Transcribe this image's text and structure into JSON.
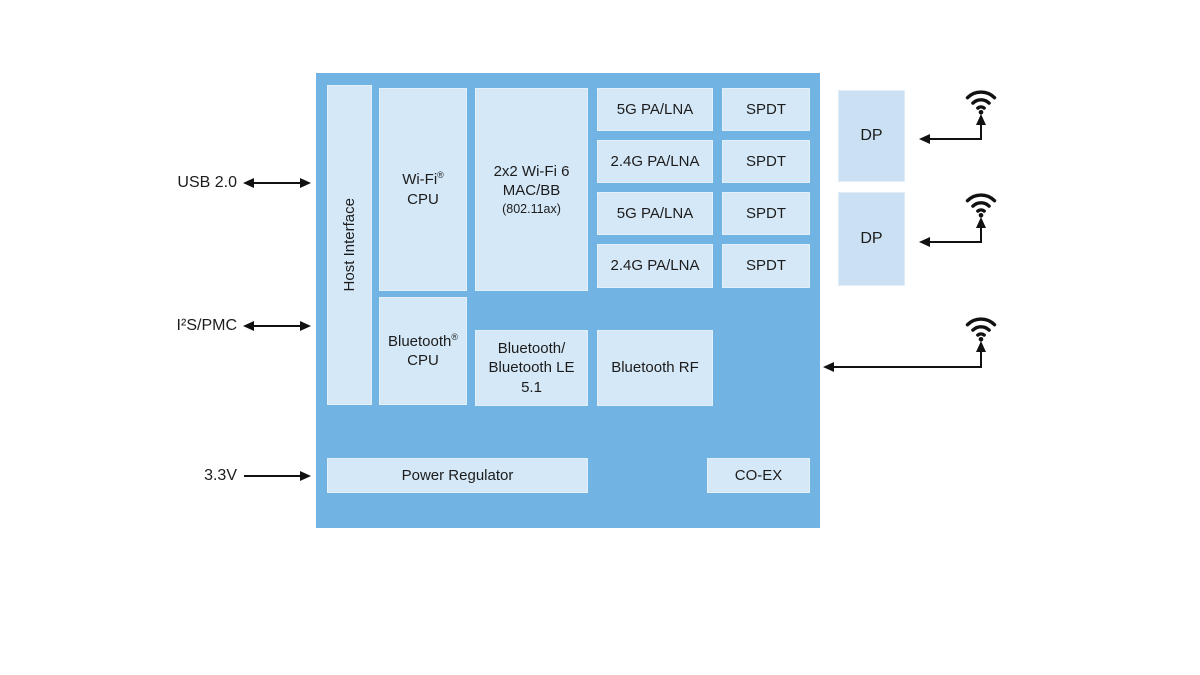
{
  "colors": {
    "chip_background": "#71B4E3",
    "inner_block_background": "#D5E8F7",
    "dp_block_background": "#CBE0F2",
    "line_color": "#111111",
    "text_color": "#1c1c1c",
    "page_background": "#ffffff"
  },
  "ports": {
    "usb": {
      "label": "USB 2.0"
    },
    "i2s": {
      "label": "I²S/PMC"
    },
    "power": {
      "label": "3.3V"
    }
  },
  "chip": {
    "host_interface": {
      "label": "Host Interface"
    },
    "wifi_cpu": {
      "name": "Wi-Fi",
      "reg": "®",
      "sub": "CPU"
    },
    "wifi_mac": {
      "line1": "2x2 Wi-Fi 6",
      "line2": "MAC/BB",
      "line3": "(802.11ax)"
    },
    "rf_rows": [
      {
        "pa": "5G PA/LNA",
        "switch": "SPDT"
      },
      {
        "pa": "2.4G PA/LNA",
        "switch": "SPDT"
      },
      {
        "pa": "5G PA/LNA",
        "switch": "SPDT"
      },
      {
        "pa": "2.4G PA/LNA",
        "switch": "SPDT"
      }
    ],
    "bt_cpu": {
      "name": "Bluetooth",
      "reg": "®",
      "sub": "CPU"
    },
    "bt_le": {
      "line1": "Bluetooth/",
      "line2": "Bluetooth LE",
      "line3": "5.1"
    },
    "bt_rf": {
      "label": "Bluetooth RF"
    },
    "power_regulator": {
      "label": "Power Regulator"
    },
    "coex": {
      "label": "CO-EX"
    }
  },
  "frontend": {
    "dp1": {
      "label": "DP"
    },
    "dp2": {
      "label": "DP"
    }
  },
  "icons": {
    "antenna1": "wifi-antenna",
    "antenna2": "wifi-antenna",
    "antenna3": "wifi-antenna"
  }
}
